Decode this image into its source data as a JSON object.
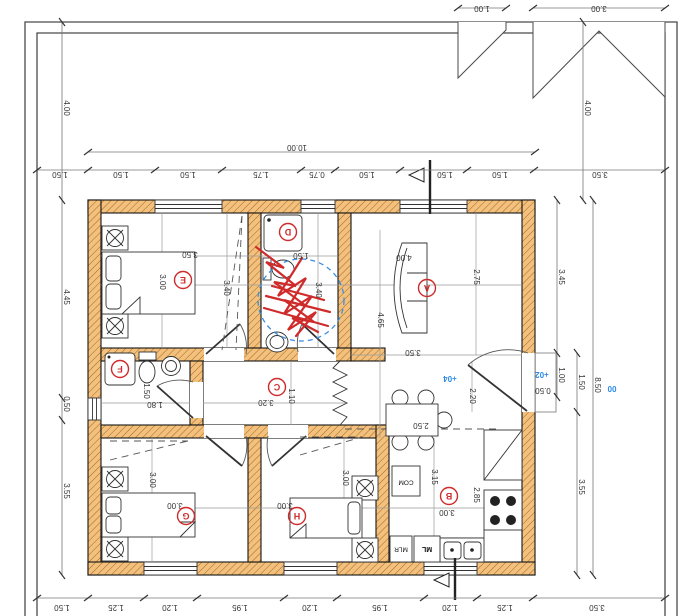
{
  "drawing": {
    "type": "architectural floor plan, rotated 180 degrees",
    "colors": {
      "wall_fill": "#f3c17d",
      "wall_hatch": "#a06820",
      "markup_red": "#cf2b2b",
      "markup_blue": "#3b8de0",
      "level_blue": "#2e8be8",
      "line": "#333333"
    }
  },
  "rooms": {
    "a": "A",
    "b": "B",
    "c": "C",
    "d": "D",
    "e": "E",
    "f": "F",
    "g": "G",
    "h": "H"
  },
  "dims": {
    "d10": "10.00",
    "m1": "1.50",
    "t1": "1.50",
    "t2": "1.50",
    "t3": "1.75",
    "t4": "0.75",
    "t5": "1.50",
    "t6": "1.50",
    "t7": "1.50",
    "t8": "3.50",
    "c1": "1.00",
    "c3": "3.00",
    "l4": "4.00",
    "r4": "4.00",
    "l445": "4.45",
    "l050": "0.50",
    "l355": "3.55",
    "lb15": "1.50",
    "b1": "1.25",
    "b2": "1.20",
    "b3": "1.95",
    "b4": "1.20",
    "b5": "1.95",
    "b6": "1.20",
    "b7": "1.25",
    "b8": "3.50",
    "r345": "3.45",
    "r100": "1.00",
    "r150": "1.50",
    "r355": "3.55",
    "r850": "8.50"
  },
  "room_dims": {
    "e_w": "3.50",
    "e_h": "3.00",
    "e_c": "3.40",
    "d_w": "1.50",
    "d_h": "3.40",
    "a_w": "4.00",
    "a_h": "2.75",
    "a_d": "4.65",
    "a_w2": "3.50",
    "c_w": "3.20",
    "c_h": "1.10",
    "f_h": "1.50",
    "f_w": "1.80",
    "g_h": "3.00",
    "g_w": "3.00",
    "h_w": "3.00",
    "h_h": "3.00",
    "b_h": "3.15",
    "b_h2": "2.85",
    "b_w": "3.00",
    "b_t": "2.50",
    "b_door": "2.20"
  },
  "levels": {
    "zero": "00",
    "p04": "+04",
    "p02": "+02",
    "step": "0.50"
  },
  "appliances": {
    "com": "COM",
    "mlr": "MLR",
    "ml": "ML"
  }
}
